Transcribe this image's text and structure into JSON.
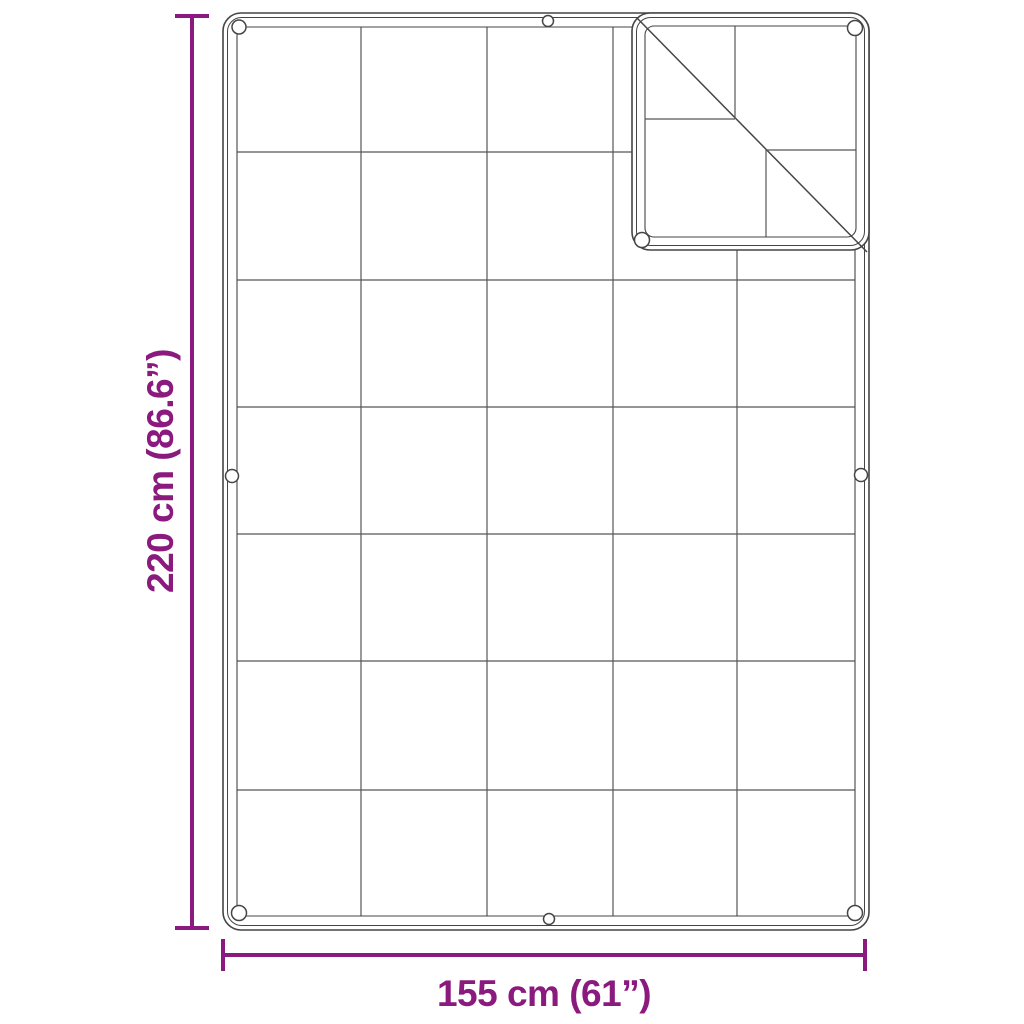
{
  "diagram": {
    "type": "product-dimension-drawing",
    "subject": "rectangular tarp with grid seams, hemmed double-line border, grommets and folded top-right corner",
    "dimensions": {
      "height_label": "220 cm (86.6”)",
      "width_label": "155 cm (61”)"
    },
    "grid": {
      "columns": 5,
      "rows": 7
    },
    "grommet_count": 9,
    "folded_corner": "top-right",
    "colors": {
      "dimension_accent": "#8B1A7E",
      "outline": "#454545",
      "grid_line": "#565656",
      "background": "#ffffff"
    }
  }
}
